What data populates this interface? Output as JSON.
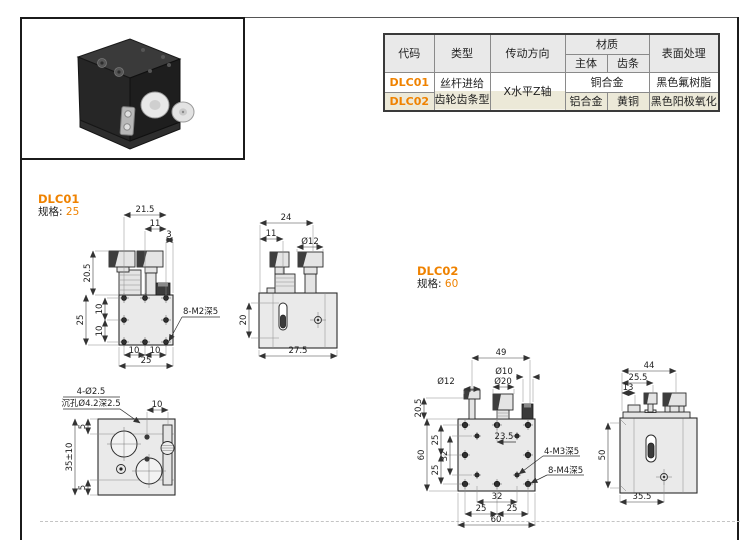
{
  "colors": {
    "accent": "#ef8200",
    "row_alt_bg": "#ece9d8",
    "header_bg": "#e9e9e9"
  },
  "spec_table": {
    "headers": {
      "code": "代码",
      "type": "类型",
      "direction": "传动方向",
      "material": "材质",
      "material_body": "主体",
      "material_rack": "齿条",
      "surface": "表面处理"
    },
    "type_lines": [
      "丝杆进给",
      "齿轮齿条型"
    ],
    "direction": "X水平Z轴",
    "rows": [
      {
        "code": "DLC01",
        "material": "铜合金",
        "surface": "黑色氟树脂"
      },
      {
        "code": "DLC02",
        "material_body": "铝合金",
        "material_rack": "黄铜",
        "surface": "黑色阳极氧化"
      }
    ]
  },
  "dlc01": {
    "code": "DLC01",
    "spec_label": "规格:",
    "spec_value": "25",
    "front": {
      "dims": [
        "21.5",
        "11",
        "3",
        "20.5",
        "25",
        "10",
        "10",
        "10",
        "10",
        "25"
      ],
      "hole_label": "8-M2深5"
    },
    "side": {
      "dims": [
        "24",
        "11",
        "Ø12",
        "20",
        "27.5"
      ]
    },
    "bottom": {
      "labels": [
        "4-Ø2.5",
        "沉孔Ø4.2深2.5"
      ],
      "dims": [
        "10",
        "5",
        "35±10",
        "5"
      ]
    }
  },
  "dlc02": {
    "code": "DLC02",
    "spec_label": "规格:",
    "spec_value": "60",
    "front": {
      "dims": [
        "49",
        "Ø10",
        "Ø20",
        "Ø12",
        "20.5",
        "60",
        "25",
        "32",
        "25",
        "23.5",
        "32",
        "25",
        "25",
        "60"
      ],
      "hole_labels": [
        "4-M3深5",
        "8-M4深5"
      ]
    },
    "side": {
      "dims": [
        "44",
        "25.5",
        "13",
        "50",
        "35.5"
      ]
    }
  }
}
